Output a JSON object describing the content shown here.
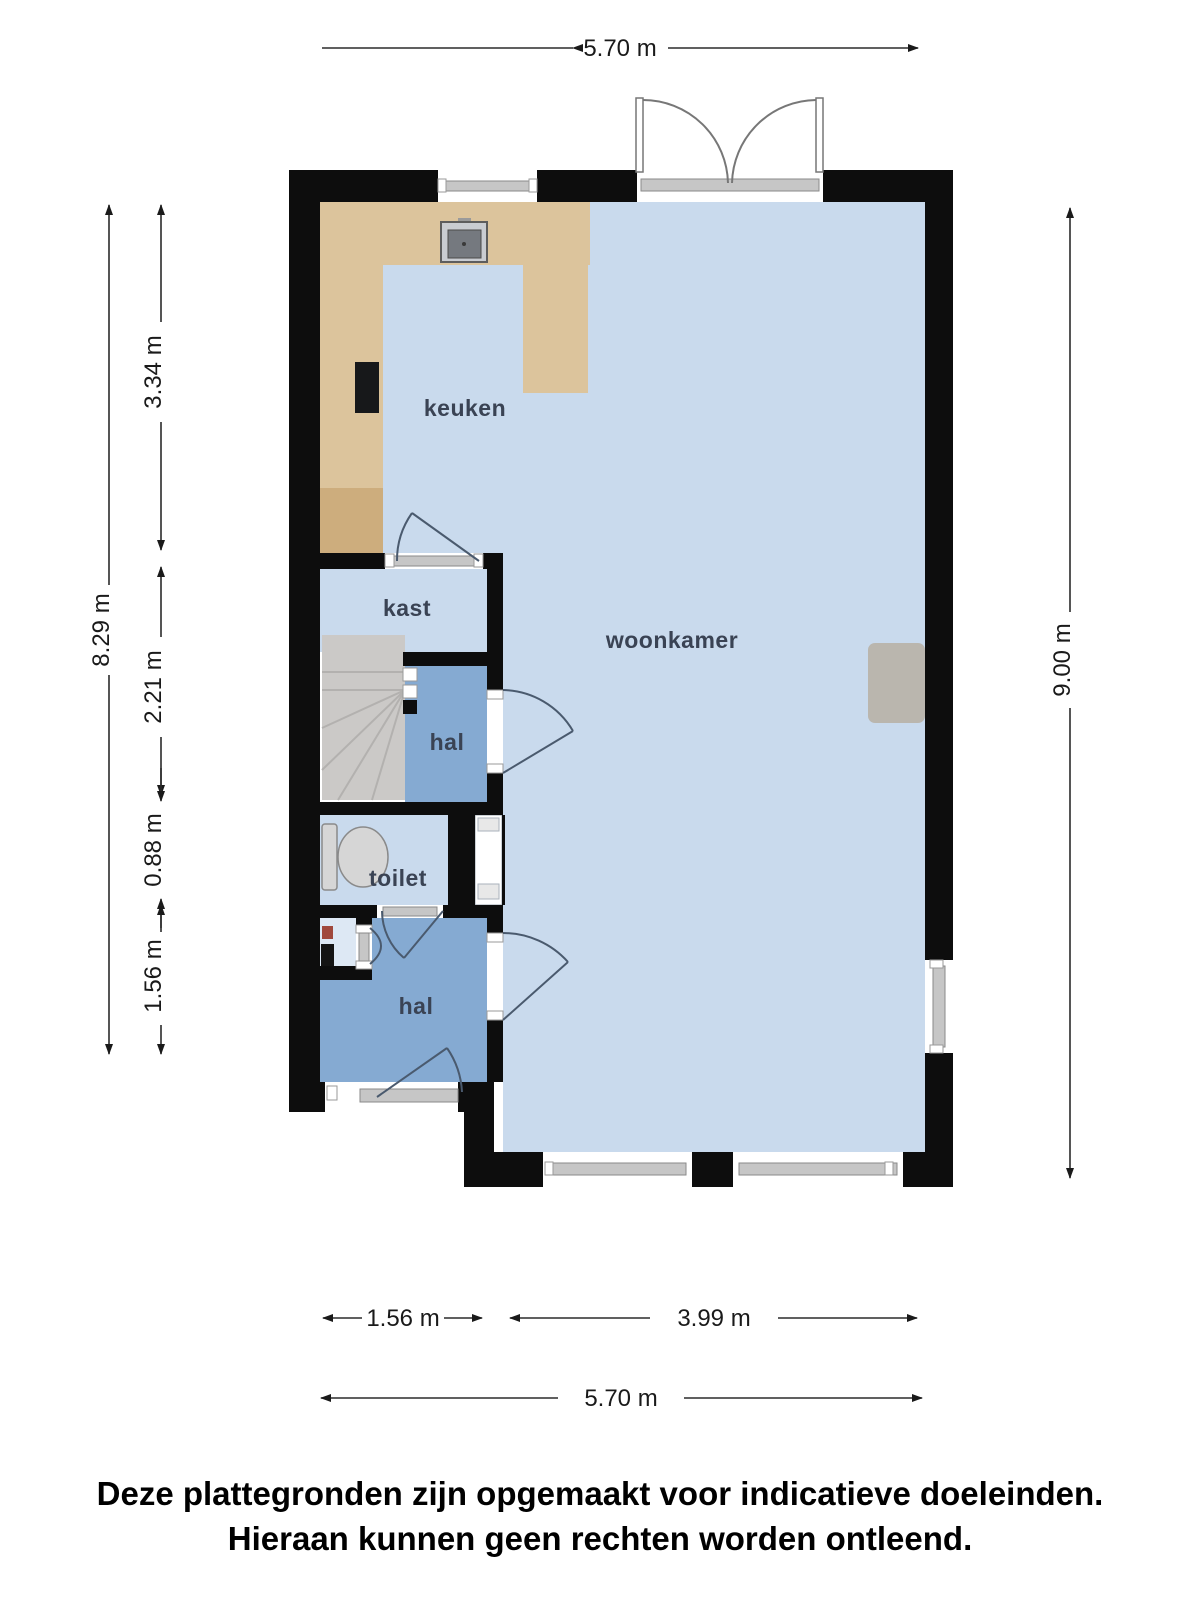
{
  "dimensions": {
    "top_width": "5.70 m",
    "left_total_height": "8.29 m",
    "left_kitchen": "3.34 m",
    "left_closet_hall": "2.21 m",
    "left_toilet": "0.88 m",
    "left_hall": "1.56 m",
    "right_height": "9.00 m",
    "bottom_hall": "1.56 m",
    "bottom_living": "3.99 m",
    "bottom_width": "5.70 m"
  },
  "rooms": {
    "kitchen": "keuken",
    "closet": "kast",
    "hall_upper": "hal",
    "toilet": "toilet",
    "hall_lower": "hal",
    "living_room": "woonkamer"
  },
  "disclaimer": {
    "line1": "Deze plattegronden zijn opgemaakt voor indicatieve doeleinden.",
    "line2": "Hieraan kunnen geen rechten worden ontleend."
  },
  "colors": {
    "wall": "#0d0d0d",
    "floor_light": "#c9daed",
    "floor_hall": "#85aad2",
    "floor_meter_closet": "#dde8f4",
    "counter": "#dcc49c",
    "counter_dark": "#cdad7d",
    "stairs": "#cbc9c7",
    "fireplace": "#bab6ae",
    "glass": "#c6c6c6",
    "room_label": "#3a4354",
    "door_arc": "#4a5a6e"
  }
}
